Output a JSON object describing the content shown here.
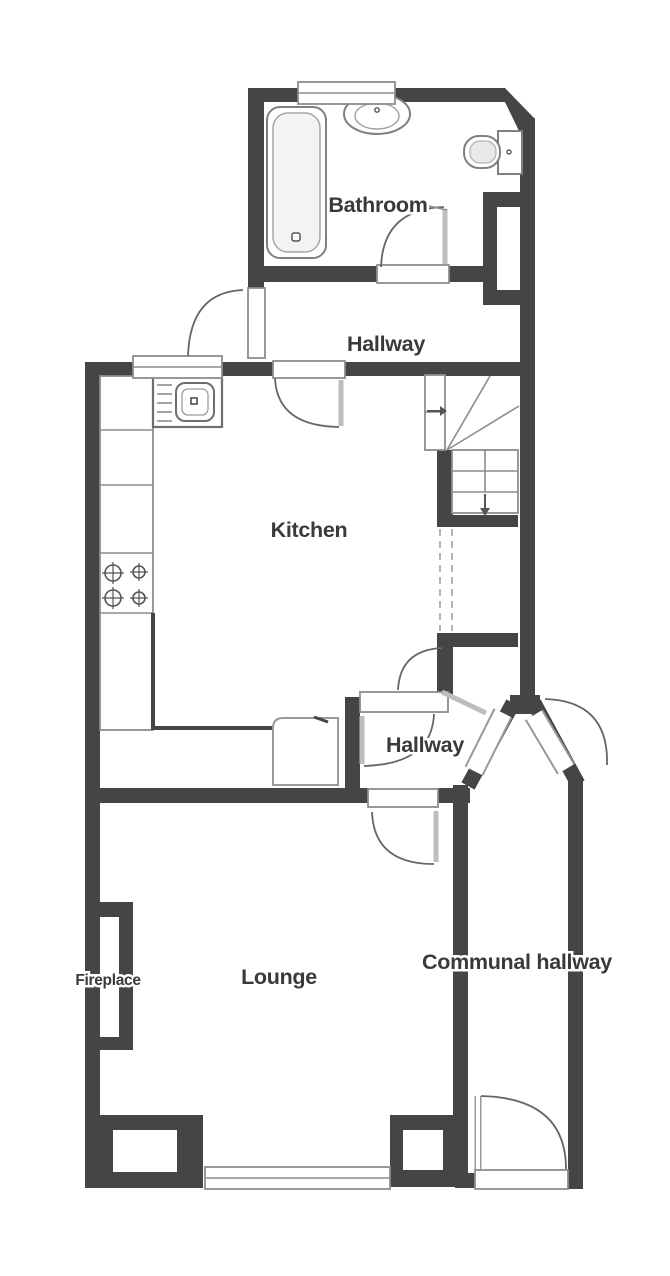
{
  "plan": {
    "type": "floorplan",
    "rooms": {
      "bathroom": {
        "label": "Bathroom"
      },
      "hallway_upper": {
        "label": "Hallway"
      },
      "kitchen": {
        "label": "Kitchen"
      },
      "hallway_lower": {
        "label": "Hallway"
      },
      "lounge": {
        "label": "Lounge"
      },
      "communal_hallway": {
        "label": "Communal hallway"
      }
    },
    "features": {
      "fireplace": {
        "label": "Fireplace"
      }
    },
    "fixtures": [
      "bath-tub",
      "wash-basin",
      "toilet",
      "kitchen-sink",
      "hob",
      "worktop",
      "stairs-up",
      "stairs-down",
      "bay-window",
      "fireplace",
      "entrance-doors"
    ],
    "colors": {
      "wall": "#454545",
      "fixture_outline": "#8c8c8c",
      "door_leaf": "#bdbdbd",
      "label_text": "#3a3a3a",
      "background": "#ffffff"
    }
  }
}
